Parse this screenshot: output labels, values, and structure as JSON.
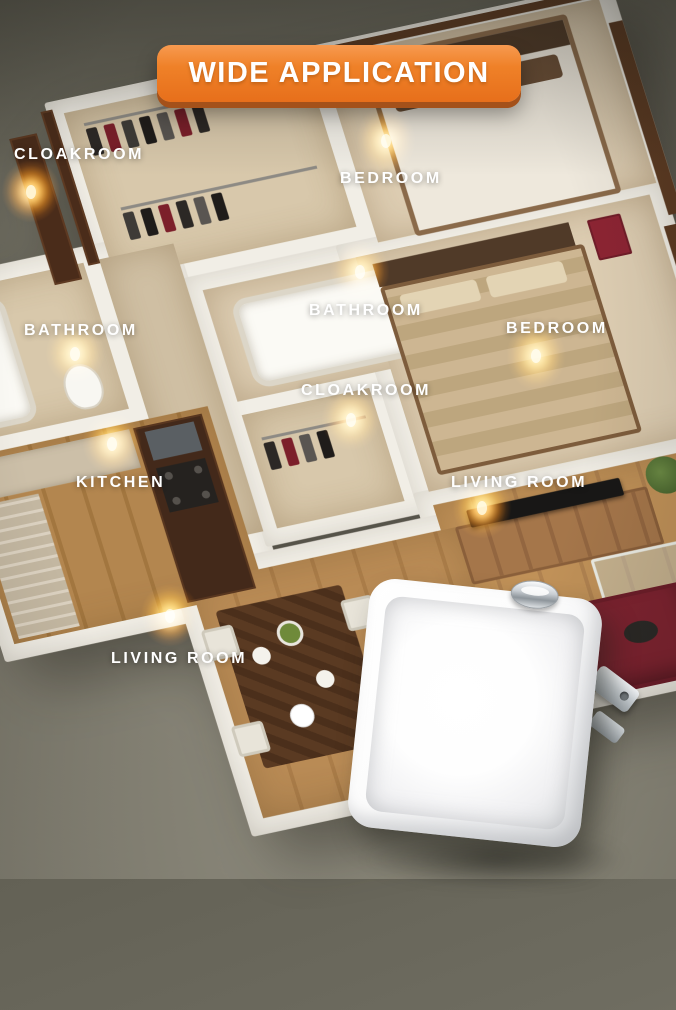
{
  "banner": {
    "label": "WIDE APPLICATION"
  },
  "room_labels": [
    {
      "text": "CLOAKROOM"
    },
    {
      "text": "BEDROOM"
    },
    {
      "text": "BATHROOM"
    },
    {
      "text": "BATHROOM"
    },
    {
      "text": "BEDROOM"
    },
    {
      "text": "CLOAKROOM"
    },
    {
      "text": "KITCHEN"
    },
    {
      "text": "LIVING ROOM"
    },
    {
      "text": "LIVING ROOM"
    }
  ],
  "night_lights": {
    "count": 9,
    "glow_color": "#ff8405",
    "glow_core": "#fff2cc"
  },
  "colors": {
    "banner_orange": "#ef8128",
    "banner_shadow": "#a4511a",
    "background_top": "#636155",
    "background_bottom": "#969384",
    "wall": "#f1eee6",
    "floor_cream": "#d8c8ab",
    "floor_wood": "#b5894f"
  },
  "product": {
    "type": "square plug-in night light",
    "body_color": "#ffffff"
  }
}
